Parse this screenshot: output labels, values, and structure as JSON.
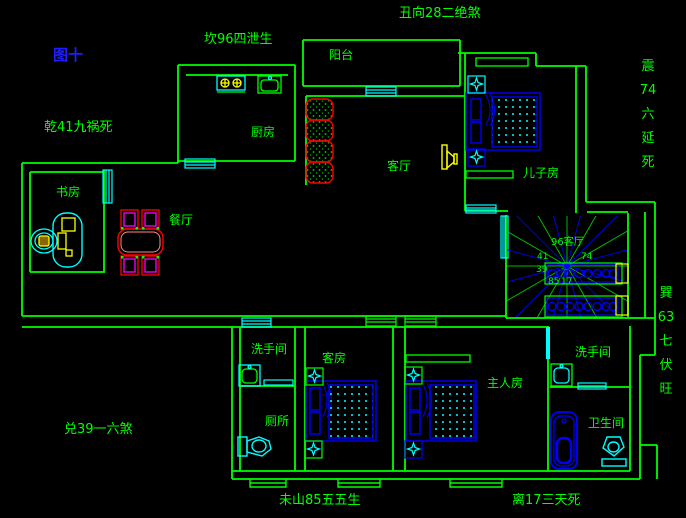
{
  "figure_label": "图十",
  "direction_labels": {
    "top": "丑向28二绝煞",
    "north": "坎96四泄生",
    "northwest": "乾41九祸死",
    "east_vertical": "震\n74\n六\n延\n死",
    "southeast_vertical": "巽\n63\n七\n伏\n旺",
    "west": "兑39一六煞",
    "south": "未山85五五生",
    "south_right": "离17三天死"
  },
  "rooms": {
    "balcony": "阳台",
    "kitchen": "厨房",
    "living_room": "客厅",
    "sons_room": "儿子房",
    "dining_room": "餐厅",
    "study": "书房",
    "washroom_left": "洗手间",
    "toilet": "厕所",
    "guest_room": "客房",
    "master_room": "主人房",
    "washroom_right": "洗手间",
    "bathroom": "卫生间"
  },
  "stair_compass": {
    "center": "96客厅",
    "nw": "41",
    "ne": "74",
    "w": "39",
    "sw": "85",
    "s": "17"
  },
  "colors": {
    "wall": "#00ff00",
    "fixture": "#00ffff",
    "furniture": "#0000ff",
    "accent_red": "#ff0000",
    "accent_magenta": "#ff00ff",
    "accent_yellow": "#ffff00",
    "figure_label_blue": "#1e1eff",
    "background": "#000000"
  }
}
